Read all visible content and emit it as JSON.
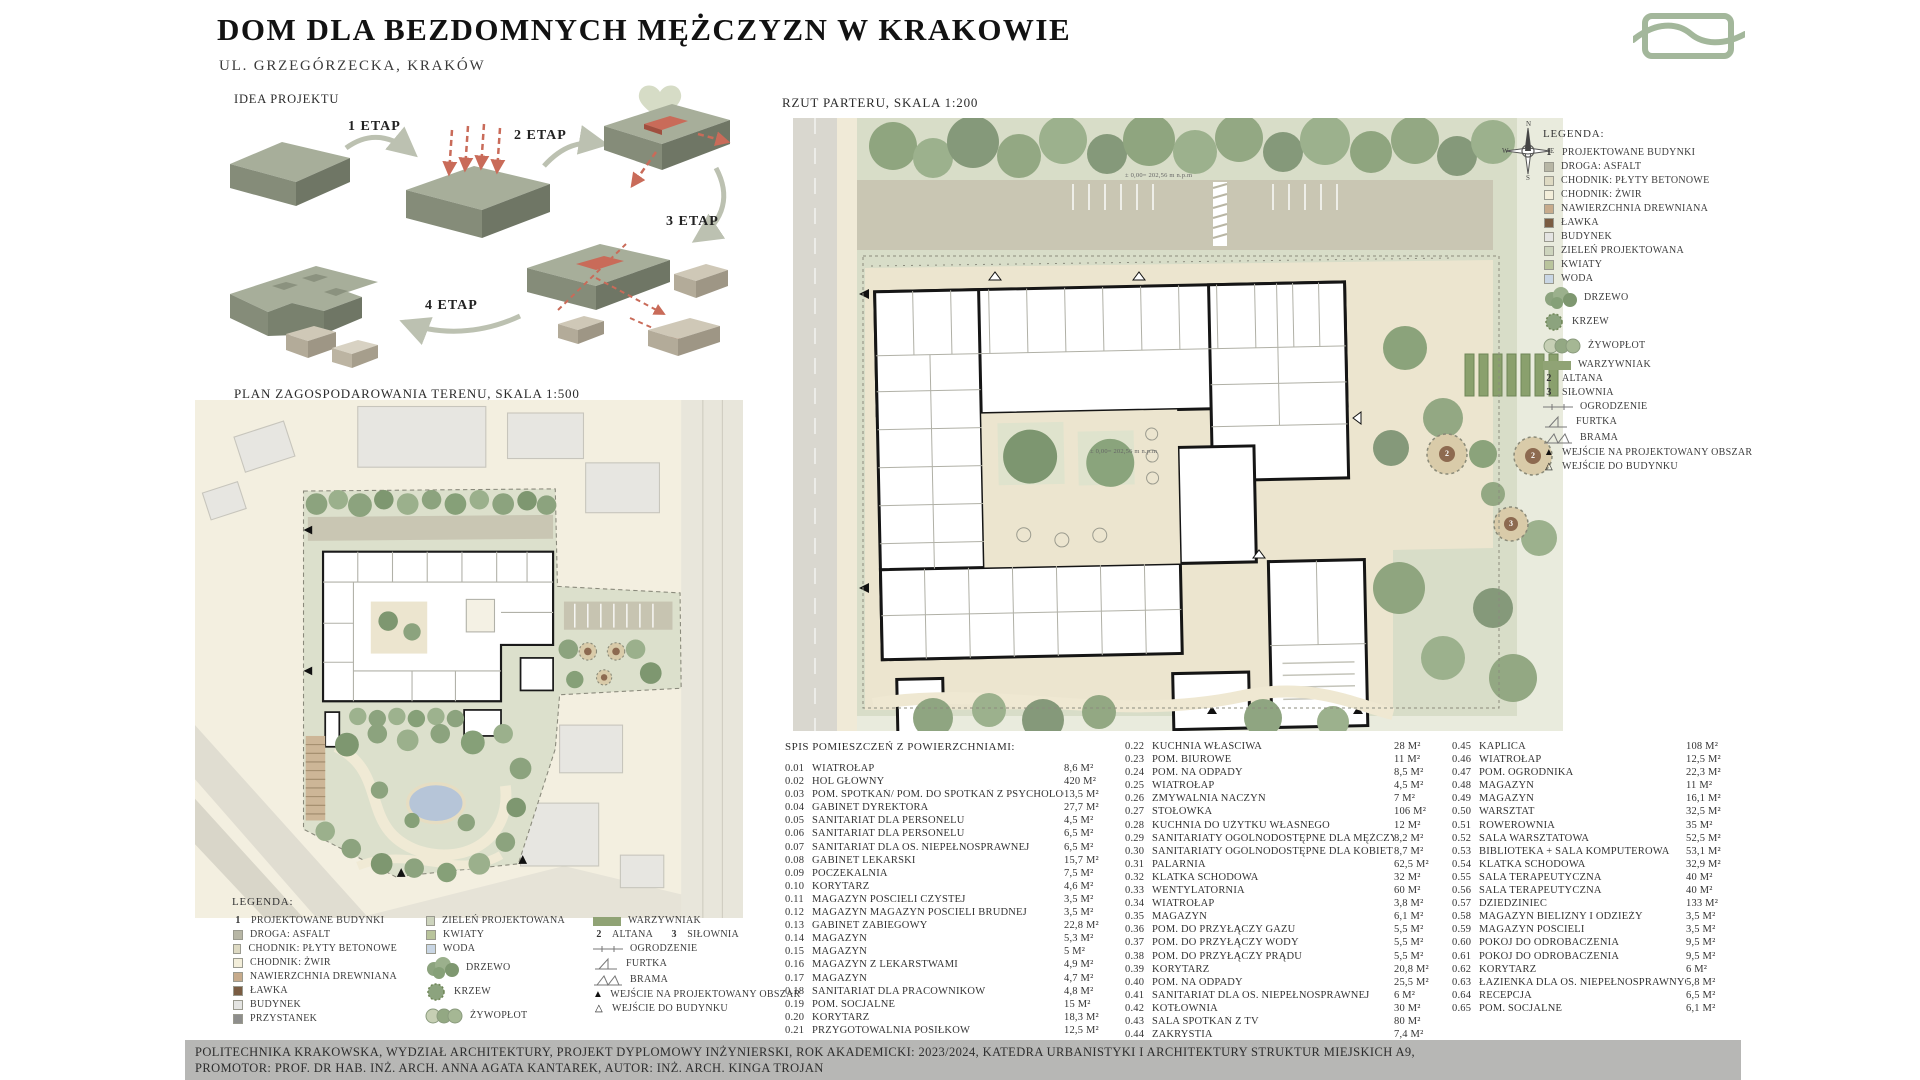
{
  "header": {
    "title": "DOM DLA BEZDOMNYCH MĘŻCZYZN W KRAKOWIE",
    "subtitle": "UL. GRZEGÓRZECKA, KRAKÓW"
  },
  "sections": {
    "idea": {
      "label": "IDEA PROJEKTU",
      "stages": [
        "1 ETAP",
        "2 ETAP",
        "3 ETAP",
        "4 ETAP"
      ]
    },
    "site_plan": {
      "label": "PLAN ZAGOSPODAROWANIA TERENU, SKALA 1:500"
    },
    "floor_plan": {
      "label": "RZUT PARTERU, SKALA 1:200"
    }
  },
  "compass": {
    "n": "N",
    "e": "E",
    "s": "S",
    "w": "W"
  },
  "floor_plan_markers": {
    "altana_1": "2",
    "altana_2": "2",
    "silownia": "3",
    "level_note": "± 0,00= 202,56 m n.p.m"
  },
  "legend_right": {
    "title": "LEGENDA:",
    "items": [
      {
        "sym": "num",
        "n": "1",
        "label": "PROJEKTOWANE BUDYNKI"
      },
      {
        "sym": "swatch",
        "color": "#b7b6a5",
        "label": "DROGA: ASFALT"
      },
      {
        "sym": "swatch",
        "color": "#dedac3",
        "label": "CHODNIK: PŁYTY BETONOWE"
      },
      {
        "sym": "swatch",
        "color": "#f3eeda",
        "label": "CHODNIK: ŻWIR"
      },
      {
        "sym": "swatch",
        "color": "#c7ab8c",
        "label": "NAWIERZCHNIA DREWNIANA"
      },
      {
        "sym": "swatch",
        "color": "#7a5c42",
        "label": "ŁAWKA"
      },
      {
        "sym": "swatch",
        "color": "#e4e4e2",
        "label": "BUDYNEK"
      },
      {
        "sym": "swatch",
        "color": "#cdd4bd",
        "label": "ZIELEŃ PROJEKTOWANA"
      },
      {
        "sym": "swatch",
        "color": "#b9c49c",
        "label": "KWIATY"
      },
      {
        "sym": "swatch",
        "color": "#c9d6e4",
        "label": "WODA"
      },
      {
        "sym": "drzewo",
        "label": "DRZEWO"
      },
      {
        "sym": "krzew",
        "label": "KRZEW"
      },
      {
        "sym": "zywoplot",
        "label": "ŻYWOPŁOT"
      },
      {
        "sym": "warzywniak",
        "label": "WARZYWNIAK"
      },
      {
        "sym": "num",
        "n": "2",
        "label": "ALTANA"
      },
      {
        "sym": "num",
        "n": "3",
        "label": "SIŁOWNIA"
      },
      {
        "sym": "ogrodzenie",
        "label": "OGRODZENIE"
      },
      {
        "sym": "furtka",
        "label": "FURTKA"
      },
      {
        "sym": "brama",
        "label": "BRAMA"
      },
      {
        "sym": "tri-filled",
        "label": "WEJŚCIE NA PROJEKTOWANY OBSZAR"
      },
      {
        "sym": "tri-open",
        "label": "WEJŚCIE DO BUDYNKU"
      }
    ]
  },
  "legend_left": {
    "title": "LEGENDA:",
    "col1": [
      {
        "sym": "num",
        "n": "1",
        "label": "PROJEKTOWANE BUDYNKI"
      },
      {
        "sym": "swatch",
        "color": "#b7b6a5",
        "label": "DROGA: ASFALT"
      },
      {
        "sym": "swatch",
        "color": "#dedac3",
        "label": "CHODNIK: PŁYTY BETONOWE"
      },
      {
        "sym": "swatch",
        "color": "#f3eeda",
        "label": "CHODNIK: ŻWIR"
      },
      {
        "sym": "swatch",
        "color": "#c7ab8c",
        "label": "NAWIERZCHNIA DREWNIANA"
      },
      {
        "sym": "swatch",
        "color": "#7a5c42",
        "label": "ŁAWKA"
      },
      {
        "sym": "swatch",
        "color": "#e4e4e2",
        "label": "BUDYNEK"
      },
      {
        "sym": "swatch",
        "color": "#8e8e8c",
        "label": "PRZYSTANEK"
      }
    ],
    "col2": [
      {
        "sym": "swatch",
        "color": "#cdd4bd",
        "label": "ZIELEŃ PROJEKTOWANA"
      },
      {
        "sym": "swatch",
        "color": "#b9c49c",
        "label": "KWIATY"
      },
      {
        "sym": "swatch",
        "color": "#c9d6e4",
        "label": "WODA"
      },
      {
        "sym": "drzewo",
        "label": "DRZEWO"
      },
      {
        "sym": "krzew",
        "label": "KRZEW"
      },
      {
        "sym": "zywoplot",
        "label": "ŻYWOPŁOT"
      }
    ],
    "col3": [
      {
        "sym": "warzywniak",
        "label": "WARZYWNIAK"
      },
      {
        "sym": "pair",
        "n1": "2",
        "l1": "ALTANA",
        "n2": "3",
        "l2": "SIŁOWNIA"
      },
      {
        "sym": "ogrodzenie",
        "label": "OGRODZENIE"
      },
      {
        "sym": "furtka",
        "label": "FURTKA"
      },
      {
        "sym": "brama",
        "label": "BRAMA"
      },
      {
        "sym": "tri-filled",
        "label": "WEJŚCIE NA PROJEKTOWANY OBSZAR"
      },
      {
        "sym": "tri-open",
        "label": "WEJŚCIE DO BUDYNKU"
      }
    ]
  },
  "room_list": {
    "title": "SPIS POMIESZCZEŃ Z POWIERZCHNIAMI:",
    "columns": [
      {
        "rooms": [
          {
            "no": "0.01",
            "name": "WIATROŁAP",
            "area": "8,6 M²"
          },
          {
            "no": "0.02",
            "name": "HOL GŁÓWNY",
            "area": "420 M²"
          },
          {
            "no": "0.03",
            "name": "POM. SPOTKAŃ/ POM. DO SPOTKAŃ Z PSYCHOLOGIEM",
            "area": "13,5 M²"
          },
          {
            "no": "0.04",
            "name": "GABINET DYREKTORA",
            "area": "27,7 M²"
          },
          {
            "no": "0.05",
            "name": "SANITARIAT DLA PERSONELU",
            "area": "4,5 M²"
          },
          {
            "no": "0.06",
            "name": "SANITARIAT DLA PERSONELU",
            "area": "6,5 M²"
          },
          {
            "no": "0.07",
            "name": "SANITARIAT DLA OS. NIEPEŁNOSPRAWNEJ",
            "area": "6,5 M²"
          },
          {
            "no": "0.08",
            "name": "GABINET LEKARSKI",
            "area": "15,7 M²"
          },
          {
            "no": "0.09",
            "name": "POCZEKALNIA",
            "area": "7,5 M²"
          },
          {
            "no": "0.10",
            "name": "KORYTARZ",
            "area": "4,6 M²"
          },
          {
            "no": "0.11",
            "name": "MAGAZYN POŚCIELI CZYSTEJ",
            "area": "3,5 M²"
          },
          {
            "no": "0.12",
            "name": "MAGAZYN  MAGAZYN POŚCIELI BRUDNEJ",
            "area": "3,5 M²"
          },
          {
            "no": "0.13",
            "name": "GABINET ZABIEGOWY",
            "area": "22,8 M²"
          },
          {
            "no": "0.14",
            "name": "MAGAZYN",
            "area": "5,3 M²"
          },
          {
            "no": "0.15",
            "name": "MAGAZYN",
            "area": "5 M²"
          },
          {
            "no": "0.16",
            "name": "MAGAZYN Z LEKARSTWAMI",
            "area": "4,9 M²"
          },
          {
            "no": "0.17",
            "name": "MAGAZYN",
            "area": "4,7 M²"
          },
          {
            "no": "0.18",
            "name": "SANITARIAT DLA PRACOWNIKÓW",
            "area": "4,8 M²"
          },
          {
            "no": "0.19",
            "name": "POM. SOCJALNE",
            "area": "15 M²"
          },
          {
            "no": "0.20",
            "name": "KORYTARZ",
            "area": "18,3 M²"
          },
          {
            "no": "0.21",
            "name": "PRZYGOTOWALNIA POSIŁKÓW",
            "area": "12,5 M²"
          }
        ]
      },
      {
        "rooms": [
          {
            "no": "0.22",
            "name": "KUCHNIA WŁAŚCIWA",
            "area": "28 M²"
          },
          {
            "no": "0.23",
            "name": "POM. BIUROWE",
            "area": "11 M²"
          },
          {
            "no": "0.24",
            "name": "POM. NA ODPADY",
            "area": "8,5 M²"
          },
          {
            "no": "0.25",
            "name": "WIATROŁAP",
            "area": "4,5 M²"
          },
          {
            "no": "0.26",
            "name": "ZMYWALNIA NACZYŃ",
            "area": "7 M²"
          },
          {
            "no": "0.27",
            "name": "STOŁÓWKA",
            "area": "106 M²"
          },
          {
            "no": "0.28",
            "name": "KUCHNIA DO UŻYTKU WŁASNEGO",
            "area": "12 M²"
          },
          {
            "no": "0.29",
            "name": "SANITARIATY OGÓLNODOSTĘPNE DLA MĘŻCZYZN",
            "area": "8,2 M²"
          },
          {
            "no": "0.30",
            "name": "SANITARIATY OGÓLNODOSTĘPNE DLA KOBIET",
            "area": "8,7 M²"
          },
          {
            "no": "0.31",
            "name": "PALARNIA",
            "area": "62,5 M²"
          },
          {
            "no": "0.32",
            "name": "KLATKA SCHODOWA",
            "area": "32 M²"
          },
          {
            "no": "0.33",
            "name": "WENTYLATORNIA",
            "area": "60 M²"
          },
          {
            "no": "0.34",
            "name": "WIATROŁAP",
            "area": "3,8 M²"
          },
          {
            "no": "0.35",
            "name": "MAGAZYN",
            "area": "6,1 M²"
          },
          {
            "no": "0.36",
            "name": "POM. DO PRZYŁĄCZY GAZU",
            "area": "5,5 M²"
          },
          {
            "no": "0.37",
            "name": "POM. DO PRZYŁĄCZY WODY",
            "area": "5,5 M²"
          },
          {
            "no": "0.38",
            "name": "POM. DO PRZYŁĄCZY PRĄDU",
            "area": "5,5 M²"
          },
          {
            "no": "0.39",
            "name": "KORYTARZ",
            "area": "20,8 M²"
          },
          {
            "no": "0.40",
            "name": "POM. NA ODPADY",
            "area": "25,5 M²"
          },
          {
            "no": "0.41",
            "name": "SANITARIAT DLA OS. NIEPEŁNOSPRAWNEJ",
            "area": "6 M²"
          },
          {
            "no": "0.42",
            "name": "KOTŁOWNIA",
            "area": "30 M²"
          },
          {
            "no": "0.43",
            "name": "SALA SPOTKAŃ Z TV",
            "area": "80 M²"
          },
          {
            "no": "0.44",
            "name": "ZAKRYSTIA",
            "area": "7,4 M²"
          }
        ]
      },
      {
        "rooms": [
          {
            "no": "0.45",
            "name": "KAPLICA",
            "area": "108 M²"
          },
          {
            "no": "0.46",
            "name": "WIATROŁAP",
            "area": "12,5 M²"
          },
          {
            "no": "0.47",
            "name": "POM. OGRODNIKA",
            "area": "22,3 M²"
          },
          {
            "no": "0.48",
            "name": "MAGAZYN",
            "area": "11 M²"
          },
          {
            "no": "0.49",
            "name": "MAGAZYN",
            "area": "16,1 M²"
          },
          {
            "no": "0.50",
            "name": "WARSZTAT",
            "area": "32,5 M²"
          },
          {
            "no": "0.51",
            "name": "ROWEROWNIA",
            "area": "35 M²"
          },
          {
            "no": "0.52",
            "name": "SALA WARSZTATOWA",
            "area": "52,5 M²"
          },
          {
            "no": "0.53",
            "name": "BIBLIOTEKA + SALA KOMPUTEROWA",
            "area": "53,1 M²"
          },
          {
            "no": "0.54",
            "name": "KLATKA SCHODOWA",
            "area": "32,9 M²"
          },
          {
            "no": "0.55",
            "name": "SALA TERAPEUTYCZNA",
            "area": "40 M²"
          },
          {
            "no": "0.56",
            "name": "SALA TERAPEUTYCZNA",
            "area": "40 M²"
          },
          {
            "no": "0.57",
            "name": "DZIEDZINIEC",
            "area": "133 M²"
          },
          {
            "no": "0.58",
            "name": "MAGAZYN BIELIZNY I ODZIEŻY",
            "area": "3,5 M²"
          },
          {
            "no": "0.59",
            "name": "MAGAZYN POŚCIELI",
            "area": "3,5 M²"
          },
          {
            "no": "0.60",
            "name": "POKÓJ DO ODROBACZENIA",
            "area": "9,5 M²"
          },
          {
            "no": "0.61",
            "name": "POKÓJ DO ODROBACZENIA",
            "area": "9,5 M²"
          },
          {
            "no": "0.62",
            "name": "KORYTARZ",
            "area": "6 M²"
          },
          {
            "no": "0.63",
            "name": "ŁAZIENKA DLA OS. NIEPEŁNOSPRAWNYCH",
            "area": "5,8 M²"
          },
          {
            "no": "0.64",
            "name": "RECEPCJA",
            "area": "6,5 M²"
          },
          {
            "no": "0.65",
            "name": "POM. SOCJALNE",
            "area": "6,1 M²"
          }
        ]
      }
    ]
  },
  "footer": {
    "line1": "POLITECHNIKA KRAKOWSKA,  WYDZIAŁ ARCHITEKTURY, PROJEKT DYPLOMOWY INŻYNIERSKI, ROK AKADEMICKI: 2023/2024, KATEDRA URBANISTYKI I ARCHITEKTURY STRUKTUR MIEJSKICH A9,",
    "line2": "PROMOTOR: PROF. DR HAB. INŻ. ARCH. ANNA AGATA KANTAREK,  AUTOR: INŻ. ARCH. KINGA TROJAN"
  },
  "colors": {
    "accent_red": "#c96b59",
    "sage": "#9bb08c",
    "logo_green": "#a3b79b",
    "footer_gray": "#b7b7b5"
  }
}
